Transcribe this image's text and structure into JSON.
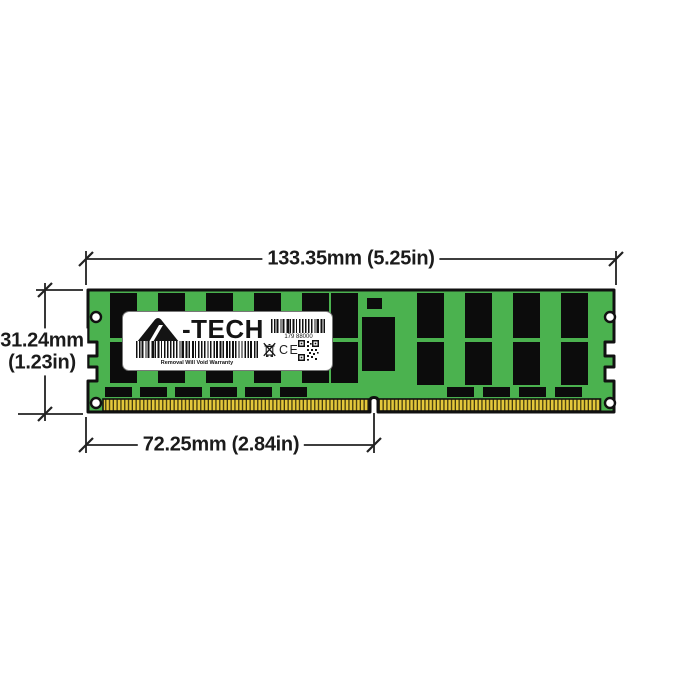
{
  "title": "A-Tech DDR4 server memory module dimension diagram",
  "dimensions": {
    "width": "133.35mm (5.25in)",
    "height_mm": "31.24mm",
    "height_in": "(1.23in)",
    "pin_width": "72.25mm (2.84in)"
  },
  "label": {
    "brand_glyph": "A",
    "brand_suffix": "-TECH",
    "serial": "179 88000",
    "warranty": "Removal Will Void Warranty",
    "ce": "CE"
  },
  "icons": [
    "a-tech-logo-icon",
    "barcode-icon",
    "weee-bin-icon",
    "ce-mark",
    "qr-code-icon"
  ],
  "colors": {
    "pcb_green": "#4BB24F",
    "chip_black": "#0C0C0C",
    "pin_gold": "#E4C83B",
    "pin_stripe": "#433A0E",
    "outline": "#111111",
    "dimension_line": "#222222",
    "text": "#1B1B1B"
  }
}
